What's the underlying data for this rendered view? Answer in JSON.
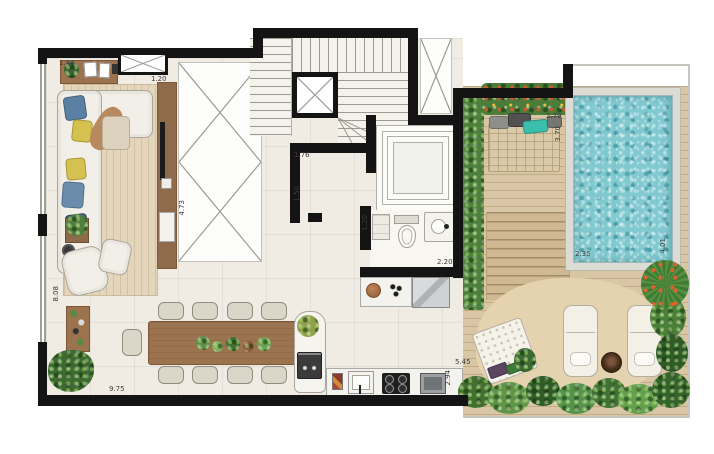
{
  "plan": {
    "description": "Duplex penthouse floor plan: living room with corner sofa and TV wall, double-height voids, U-shaped staircase, elevator, bathroom, kitchen with island, nine-seat dining table, and outdoor terrace with hedge planting, daybed deck, timber steps, plunge pool and sand lounge with two sun loungers",
    "dimension_unit": "m",
    "dimension_labels": [
      {
        "text": "1.44",
        "x": 59,
        "y": 59,
        "vertical": false
      },
      {
        "text": "1.20",
        "x": 151,
        "y": 75,
        "vertical": false
      },
      {
        "text": "4.73",
        "x": 178,
        "y": 200,
        "vertical": true
      },
      {
        "text": "8.08",
        "x": 52,
        "y": 286,
        "vertical": true
      },
      {
        "text": "1.76",
        "x": 294,
        "y": 151,
        "vertical": false
      },
      {
        "text": "1.50",
        "x": 293,
        "y": 186,
        "vertical": true
      },
      {
        "text": "1.20",
        "x": 361,
        "y": 215,
        "vertical": true
      },
      {
        "text": "2.20",
        "x": 437,
        "y": 258,
        "vertical": false
      },
      {
        "text": "2.79",
        "x": 546,
        "y": 112,
        "vertical": false
      },
      {
        "text": "3.70",
        "x": 554,
        "y": 126,
        "vertical": true
      },
      {
        "text": "2.35",
        "x": 575,
        "y": 250,
        "vertical": false
      },
      {
        "text": "4.01",
        "x": 659,
        "y": 238,
        "vertical": true
      },
      {
        "text": "9.75",
        "x": 109,
        "y": 385,
        "vertical": false
      },
      {
        "text": "5.45",
        "x": 455,
        "y": 358,
        "vertical": false
      },
      {
        "text": "2.94",
        "x": 444,
        "y": 370,
        "vertical": true
      }
    ],
    "colors": {
      "wall": "#141414",
      "interior_floor": "#f0ece4",
      "timber_deck": "#d9c6a4",
      "rug": "#e4d6ba",
      "pool_water": "#80c9cf",
      "pool_coping": "#dcdcd4",
      "foliage_green": "#4e7f3d",
      "sand": "#e4d3ae",
      "furniture_wood": "#9c734f",
      "pillow_teal": "#39bfab",
      "cushion_blue": "#5b80a3",
      "cushion_yellow": "#d4c14f"
    }
  }
}
